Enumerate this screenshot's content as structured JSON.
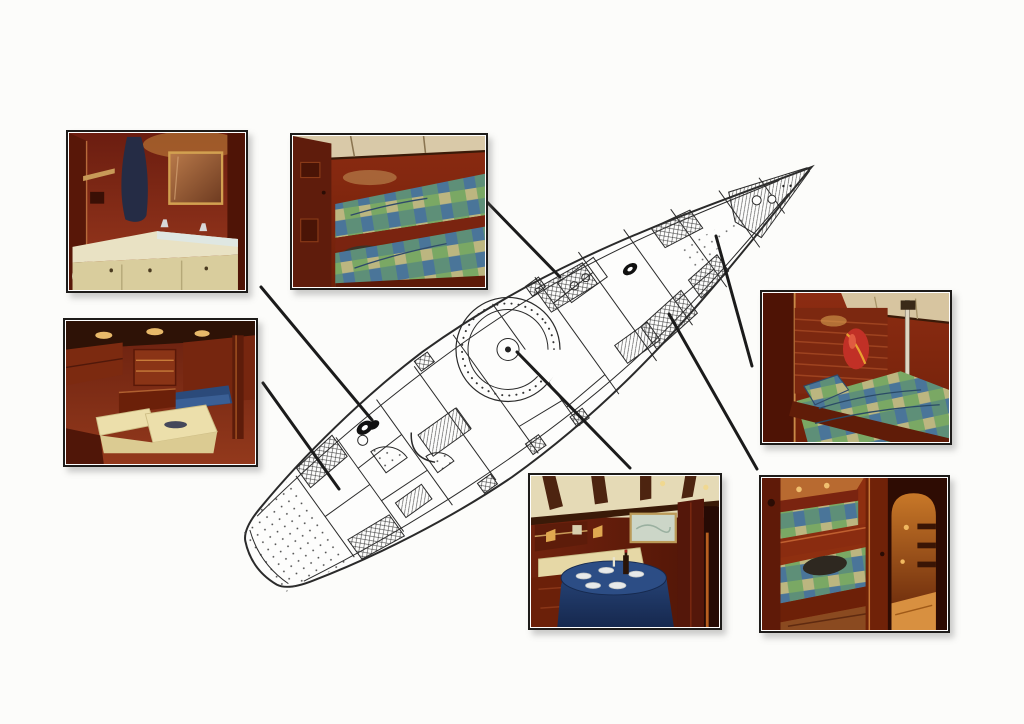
{
  "page": {
    "background_color": "#fcfcfa",
    "description": "Scanned yacht brochure page: interior deck plan with six photo callouts, no text"
  },
  "plan": {
    "name": "yacht-deck-plan",
    "ink_color": "#2a2a2a",
    "bow_direction": "upper-right",
    "stern_direction": "lower-left"
  },
  "photos": [
    {
      "id": "photo-head",
      "subject": "head with cream vanity, gold-framed mirror and hanging robe"
    },
    {
      "id": "photo-fore-cabin",
      "subject": "forward cabin with two plaid-covered bunk berths"
    },
    {
      "id": "photo-salon",
      "subject": "saloon with cream L-shaped settee and overhead lights"
    },
    {
      "id": "photo-starboard-cabin",
      "subject": "cabin berth with plaid spread, life vest and stanchion pole"
    },
    {
      "id": "photo-dining",
      "subject": "dining saloon, round table with blue cloth, plates and wine"
    },
    {
      "id": "photo-guest-cabin",
      "subject": "guest bunk cabin beside warm-lit companionway corridor"
    }
  ],
  "connectors": {
    "color": "#1b1b1b",
    "width": 3,
    "lines": [
      {
        "photo": "photo-head",
        "x1": 261,
        "y1": 287,
        "x2": 372,
        "y2": 420
      },
      {
        "photo": "photo-salon",
        "x1": 263,
        "y1": 383,
        "x2": 339,
        "y2": 489
      },
      {
        "photo": "photo-fore-cabin",
        "x1": 486,
        "y1": 201,
        "x2": 560,
        "y2": 277
      },
      {
        "photo": "photo-starboard-cabin",
        "x1": 752,
        "y1": 366,
        "x2": 716,
        "y2": 236
      },
      {
        "photo": "photo-guest-cabin",
        "x1": 757,
        "y1": 469,
        "x2": 669,
        "y2": 314
      },
      {
        "photo": "photo-dining",
        "x1": 630,
        "y1": 468,
        "x2": 517,
        "y2": 352
      }
    ]
  }
}
